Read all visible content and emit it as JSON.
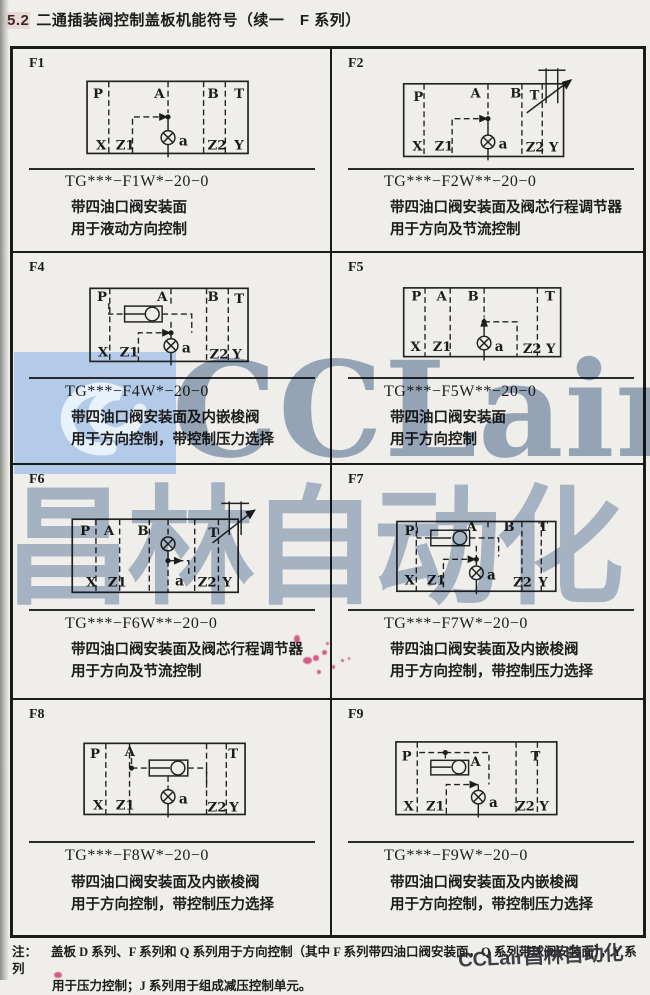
{
  "page": {
    "header_num": "5.2",
    "header_title": "二通插装阀控制盖板机能符号（续一　F 系列）"
  },
  "cells": [
    {
      "id": "F1",
      "model": "TG***−F1W*−20−0",
      "desc1": "带四油口阀安装面",
      "desc2": "用于液动方向控制",
      "ports": {
        "p": "P",
        "a_top": "A",
        "b": "B",
        "t": "T",
        "x": "X",
        "z1": "Z1",
        "z2": "Z2",
        "y": "Y",
        "a": "a"
      }
    },
    {
      "id": "F2",
      "model": "TG***−F2W**−20−0",
      "desc1": "带四油口阀安装面及阀芯行程调节器",
      "desc2": "用于方向及节流控制",
      "ports": {
        "p": "P",
        "a_top": "A",
        "b": "B",
        "t": "T",
        "x": "X",
        "z1": "Z1",
        "z2": "Z2",
        "y": "Y",
        "a": "a"
      }
    },
    {
      "id": "F4",
      "model": "TG***−F4W*−20−0",
      "desc1": "带四油口阀安装面及内嵌梭阀",
      "desc2": "用于方向控制，带控制压力选择",
      "ports": {
        "p": "P",
        "a_top": "A",
        "b": "B",
        "t": "T",
        "x": "X",
        "z1": "Z1",
        "z2": "Z2",
        "y": "Y",
        "a": "a"
      }
    },
    {
      "id": "F5",
      "model": "TG***−F5W**−20−0",
      "desc1": "带四油口阀安装面",
      "desc2": "用于方向控制",
      "ports": {
        "p": "P",
        "a_top": "A",
        "b": "B",
        "t": "T",
        "x": "X",
        "z1": "Z1",
        "z2": "Z2",
        "y": "Y",
        "a": "a"
      }
    },
    {
      "id": "F6",
      "model": "TG***−F6W**−20−0",
      "desc1": "带四油口阀安装面及阀芯行程调节器",
      "desc2": "用于方向及节流控制",
      "ports": {
        "p": "P",
        "a_top": "A",
        "b": "B",
        "t": "T",
        "x": "X",
        "z1": "Z1",
        "z2": "Z2",
        "y": "Y",
        "a": "a"
      }
    },
    {
      "id": "F7",
      "model": "TG***−F7W*−20−0",
      "desc1": "带四油口阀安装面及内嵌梭阀",
      "desc2": "用于方向控制，带控制压力选择",
      "ports": {
        "p": "P",
        "a_top": "A",
        "b": "B",
        "t": "T",
        "x": "X",
        "z1": "Z1",
        "z2": "Z2",
        "y": "Y",
        "a": "a"
      }
    },
    {
      "id": "F8",
      "model": "TG***−F8W*−20−0",
      "desc1": "带四油口阀安装面及内嵌梭阀",
      "desc2": "用于方向控制，带控制压力选择",
      "ports": {
        "p": "P",
        "a_top": "A",
        "t": "T",
        "x": "X",
        "z1": "Z1",
        "z2": "Z2",
        "y": "Y",
        "a": "a"
      }
    },
    {
      "id": "F9",
      "model": "TG***−F9W*−20−0",
      "desc1": "带四油口阀安装面及内嵌梭阀",
      "desc2": "用于方向控制，带控制压力选择",
      "ports": {
        "p": "P",
        "a_top": "A",
        "t": "T",
        "x": "X",
        "z1": "Z1",
        "z2": "Z2",
        "y": "Y",
        "a": "a"
      }
    }
  ],
  "note": {
    "label": "注：",
    "line1": "盖板 D 系列、F 系列和 Q 系列用于方向控制（其中 F 系列带四油口阀安装面，Q 系列带球阀安装面），Y 系列",
    "line2": "用于压力控制；J 系列用于组成减压控制单元。"
  },
  "watermark": {
    "brand": "CCLair",
    "brand_cn": "昌林自动化",
    "corner": "CCLair昌林自动化"
  },
  "colors": {
    "watermark_blue": "#b3cbe9",
    "watermark_gray_blue": "#97a9c1",
    "ink": "#1c1c1c",
    "red_mark": "#c42c68"
  }
}
